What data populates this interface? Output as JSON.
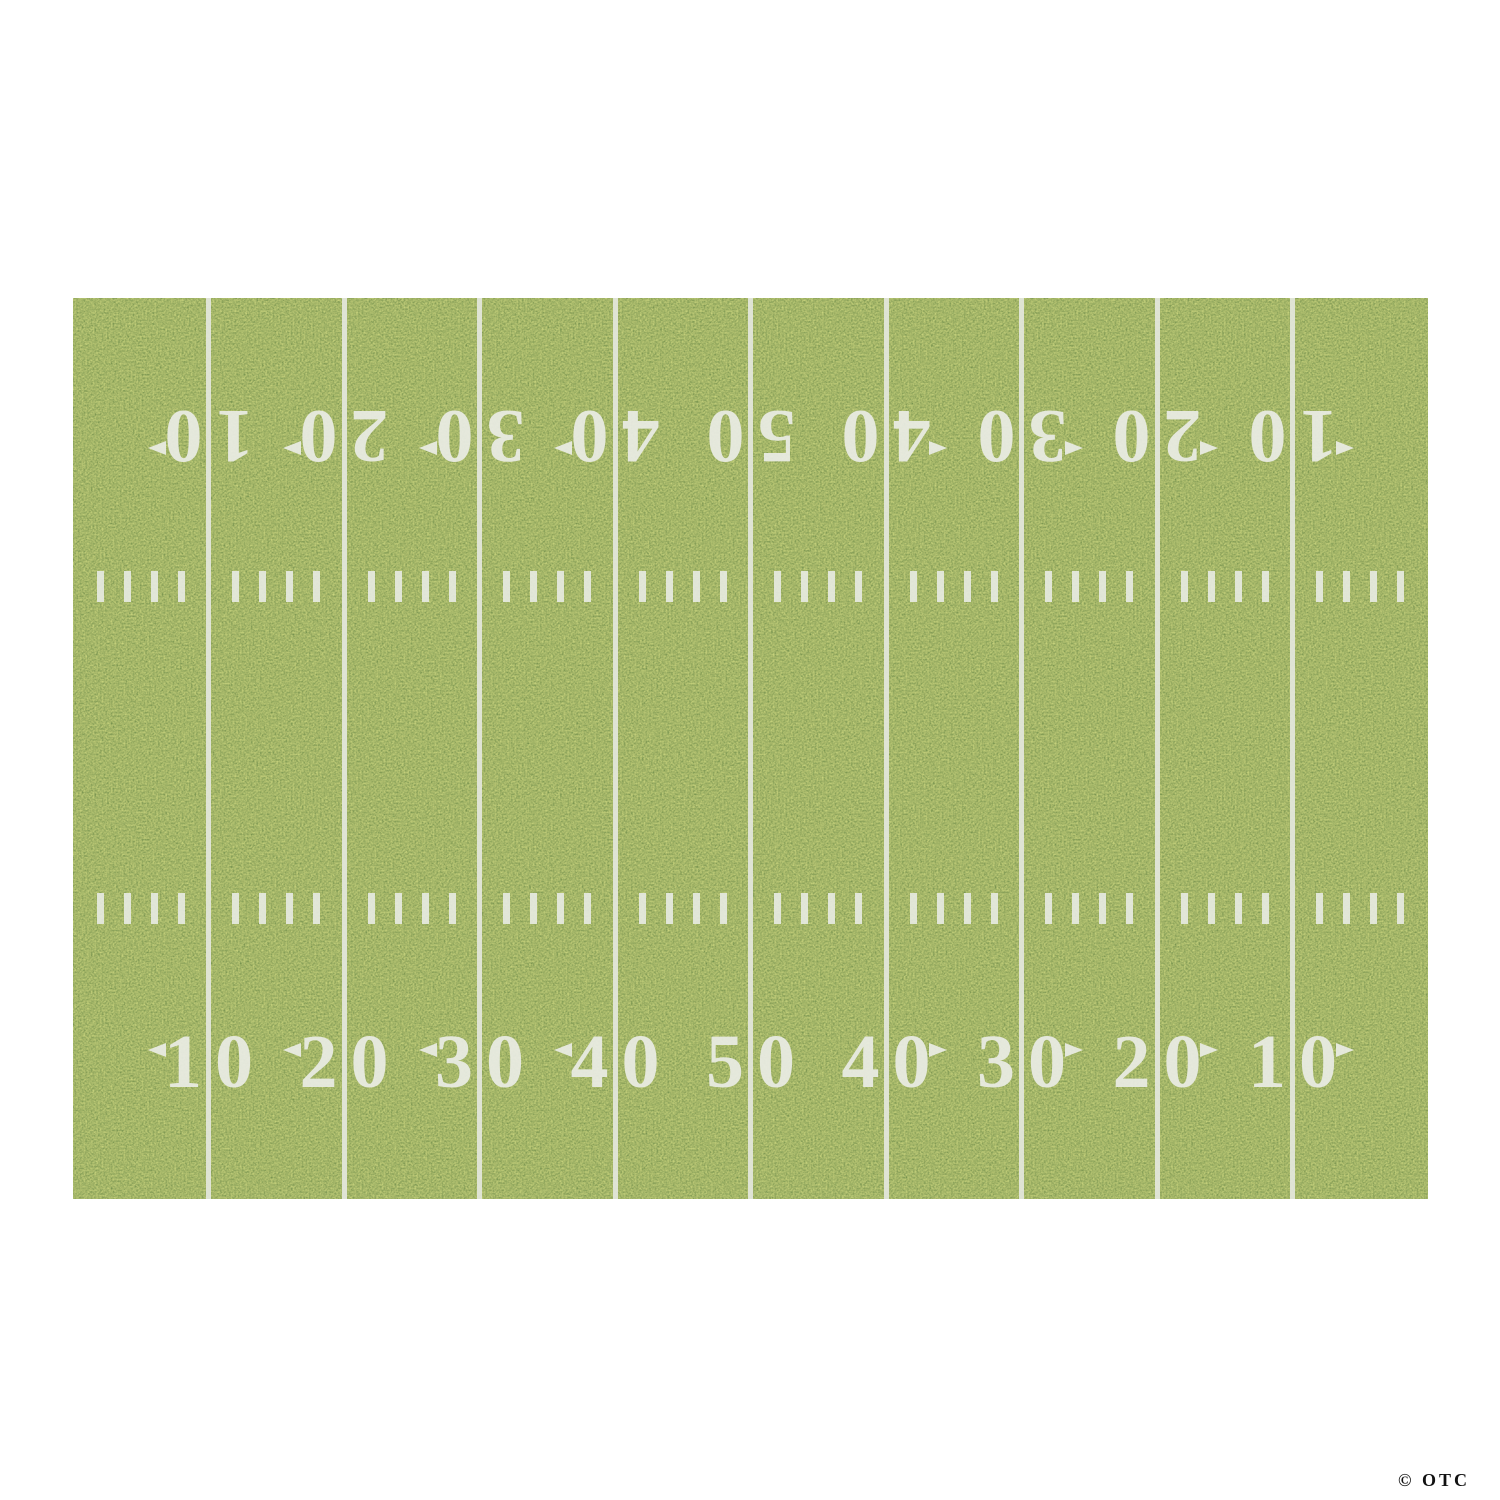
{
  "canvas": {
    "width": 1500,
    "height": 1500,
    "background": "#ffffff"
  },
  "field": {
    "x": 73,
    "y": 298,
    "width": 1355,
    "height": 901,
    "zones": 10,
    "yard_numbers": [
      "10",
      "20",
      "30",
      "40",
      "50",
      "40",
      "30",
      "20",
      "10"
    ],
    "number_rows": [
      {
        "name": "top",
        "top": 109,
        "rotated": true
      },
      {
        "name": "bottom",
        "top": 721,
        "rotated": false
      }
    ],
    "hash_rows": [
      {
        "name": "upper",
        "top": 273
      },
      {
        "name": "lower",
        "top": 595
      }
    ],
    "hash_marks_per_zone": 4,
    "colors": {
      "grass_dark": "#24390f",
      "grass_mid": "#5d7a2a",
      "grass_light": "#b9c26a",
      "line": "#e4e7dd",
      "number": "#eaece4"
    }
  },
  "watermark": {
    "text": "© OTC",
    "color": "#111111"
  }
}
